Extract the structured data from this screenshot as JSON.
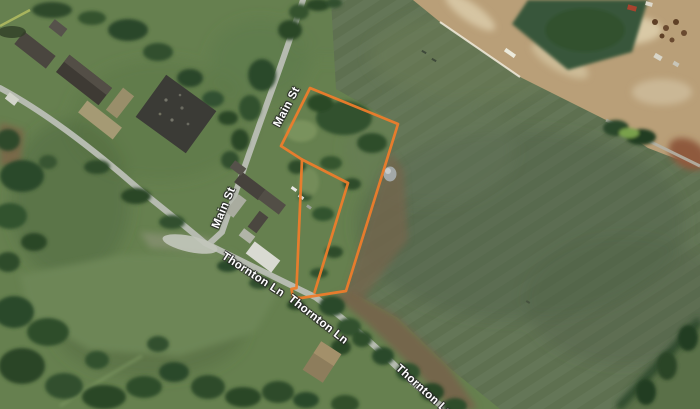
{
  "map": {
    "boundary_color": "#ED7C2B",
    "road_labels": [
      {
        "id": "main-st-upper",
        "text": "Main St"
      },
      {
        "id": "main-st-lower",
        "text": "Main St"
      },
      {
        "id": "thornton-ln-west",
        "text": "Thornton Ln"
      },
      {
        "id": "thornton-ln-east",
        "text": "Thornton Ln"
      },
      {
        "id": "thornton-ln-far",
        "text": "Thornton Ln"
      }
    ]
  }
}
